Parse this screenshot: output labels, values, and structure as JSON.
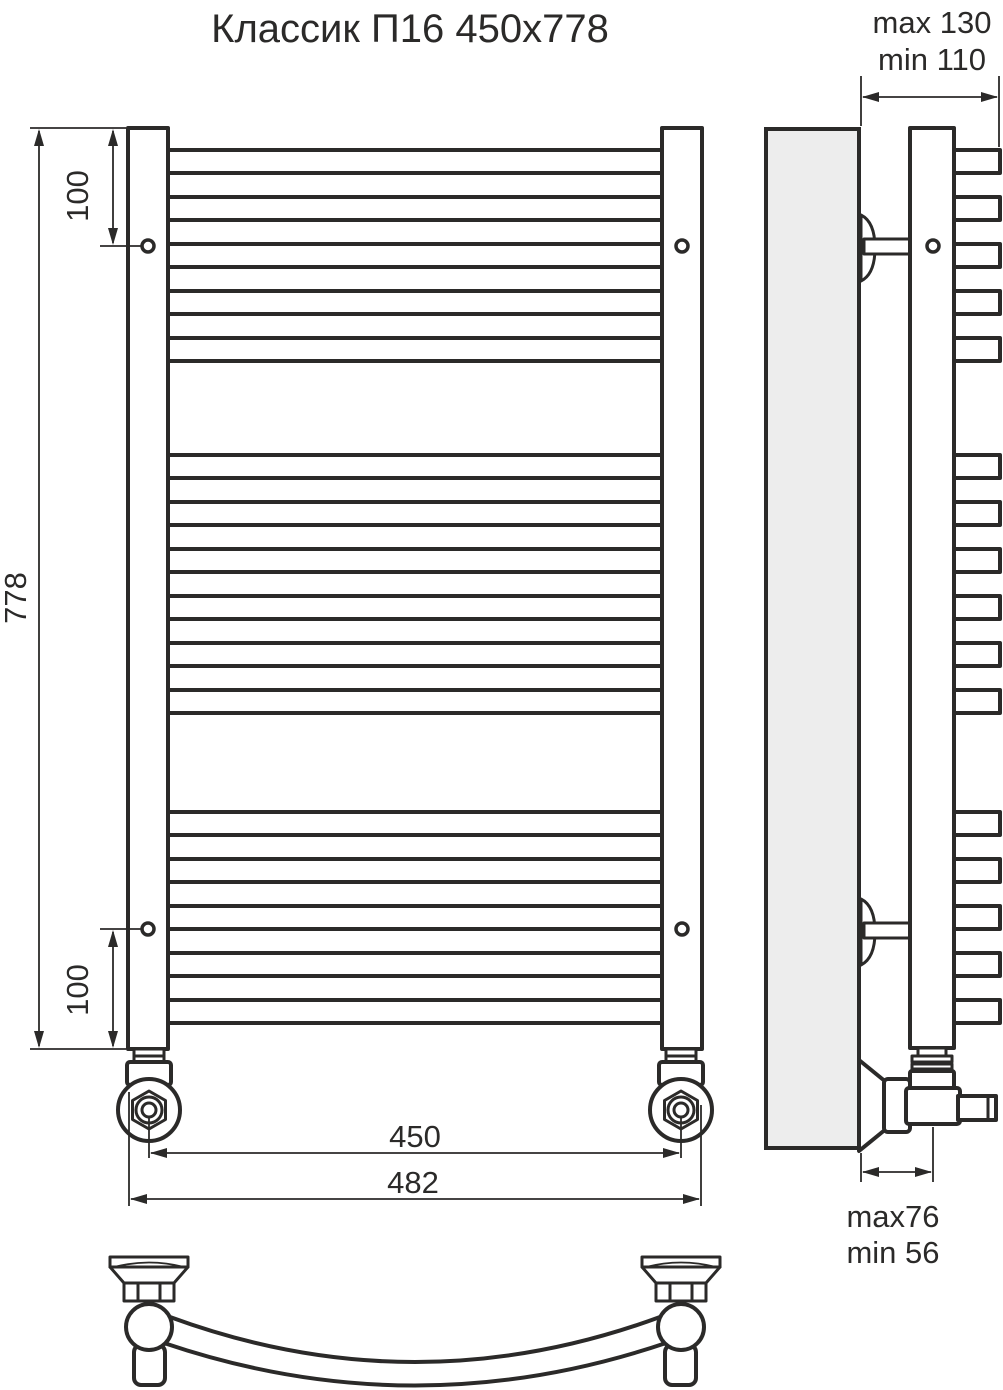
{
  "title": "Классик П16 450х778",
  "colors": {
    "line": "#2b2a29",
    "wall_fill": "#ededed",
    "background": "#ffffff"
  },
  "product": {
    "rung_count": 16,
    "rung_groups": [
      5,
      6,
      5
    ]
  },
  "dimensions": {
    "front": {
      "overall_height": "778",
      "top_bracket_offset": "100",
      "bottom_bracket_offset": "100",
      "pipe_axis_width": "450",
      "overall_width": "482"
    },
    "side": {
      "depth_max": "max 130",
      "depth_min": "min 110",
      "axis_depth_max": "max76",
      "axis_depth_min": "min 56"
    }
  }
}
